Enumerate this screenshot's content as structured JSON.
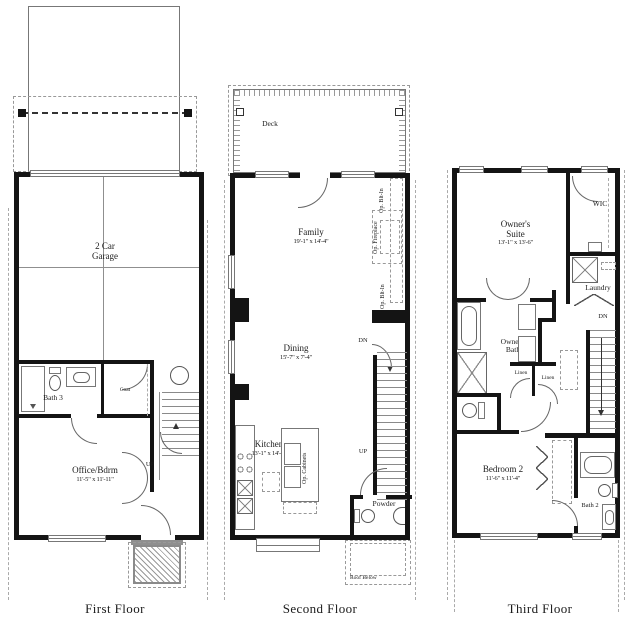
{
  "floors": {
    "first": {
      "title": "First Floor",
      "garage": {
        "name": "2 Car Garage"
      },
      "bath3": {
        "name": "Bath 3"
      },
      "coat": {
        "name": "Coat"
      },
      "office": {
        "name": "Office/Bdrm",
        "dims": "11'-5\" x 11'-11\""
      },
      "stairs_up": "UP"
    },
    "second": {
      "title": "Second Floor",
      "deck": {
        "name": "Deck"
      },
      "family": {
        "name": "Family",
        "dims": "19'-1\" x 14'-4\""
      },
      "dining": {
        "name": "Dining",
        "dims": "15'-7\" x 7'-4\""
      },
      "kitchen": {
        "name": "Kitchen",
        "dims": "13'-1\" x 14'-1\""
      },
      "powder": {
        "name": "Powder"
      },
      "op_fireplace": "Op. Fireplace",
      "op_bltin_upper": "Op. Blt-In",
      "op_bltin_lower": "Op. Blt-In",
      "op_cabinets": "Op. Cabinets",
      "roof_below": "Roof Below",
      "stairs_dn": "DN",
      "stairs_up": "UP"
    },
    "third": {
      "title": "Third Floor",
      "owners_suite": {
        "name": "Owner's Suite",
        "dims": "13'-1\" x 13'-6\""
      },
      "wic": {
        "name": "WIC"
      },
      "laundry": {
        "name": "Laundry"
      },
      "owners_bath": {
        "name": "Owner's Bath"
      },
      "linen_a": "Linen",
      "linen_b": "Linen",
      "bedroom2": {
        "name": "Bedroom 2",
        "dims": "11'-6\" x 11'-4\""
      },
      "bath2": {
        "name": "Bath 2"
      },
      "stairs_dn": "DN"
    }
  },
  "colors": {
    "wall": "#141414",
    "line": "#8f8f8f",
    "text": "#1b1b1b",
    "background": "#ffffff"
  }
}
